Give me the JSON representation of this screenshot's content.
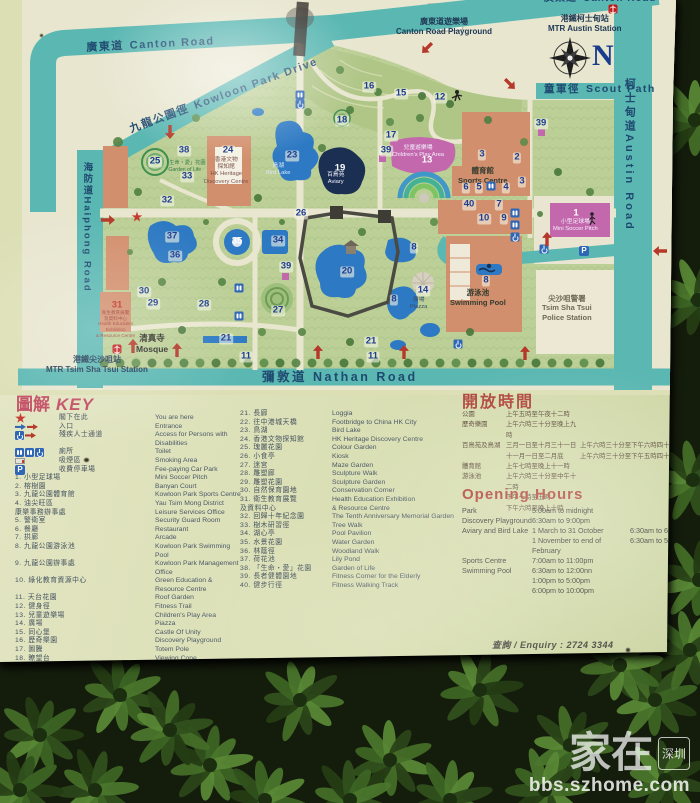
{
  "glyphs": {
    "parking": "P"
  },
  "colors": {
    "accent_red": "#b0443c",
    "road_teal": "#5ab7b2",
    "water_blue": "#2d79c3",
    "building_salmon": "#d28f6d",
    "magenta": "#c468ae",
    "marker_navy": "#1d3c8f"
  },
  "map": {
    "labels": [
      {
        "cls": "road",
        "x": 86,
        "y": 42,
        "rot": -3,
        "zh": "廣東道",
        "en": "Canton Road"
      },
      {
        "cls": "road cut",
        "x": 544,
        "y": -7,
        "rot": 0,
        "zh": "廣東道",
        "en": "Canton Road"
      },
      {
        "cls": "road",
        "x": 128,
        "y": 124,
        "rot": -20,
        "zh": "九龍公園徑",
        "en": "Kowloon Park Drive"
      },
      {
        "cls": "station",
        "x": 548,
        "y": 14,
        "rot": 0,
        "zh": "港鐵柯士甸站",
        "en": "MTR Austin Station"
      },
      {
        "cls": "road scout",
        "x": 544,
        "y": 83,
        "rot": 0,
        "zh": "童軍徑",
        "en": "Scout Path"
      },
      {
        "cls": "roadv",
        "x": 622,
        "y": 78,
        "rot": 0,
        "zh": "柯士甸道",
        "en": "Austin Road"
      },
      {
        "cls": "roadv small",
        "x": 81,
        "y": 162,
        "rot": 0,
        "zh": "海防道",
        "en": "Haiphong Road"
      },
      {
        "cls": "road nathan",
        "x": 262,
        "y": 370,
        "rot": 0,
        "zh": "彌敦道",
        "en": "Nathan Road"
      },
      {
        "cls": "station",
        "x": 396,
        "y": 17,
        "rot": 0,
        "zh": "廣東道遊樂場",
        "en": "Canton Road Playground"
      },
      {
        "cls": "place",
        "x": 136,
        "y": 333,
        "rot": 0,
        "zh": "清真寺",
        "en": "Mosque"
      },
      {
        "cls": "station",
        "x": 46,
        "y": 355,
        "rot": 0,
        "zh": "港鐵尖沙咀站",
        "en": "MTR Tsim Sha Tsui Station"
      },
      {
        "cls": "place small",
        "x": 542,
        "y": 294,
        "rot": 0,
        "zh": "尖沙咀警署",
        "en": "Tsim Sha Tsui\nPolice Station"
      },
      {
        "cls": "bldg",
        "x": 458,
        "y": 166,
        "rot": 0,
        "zh": "體育館",
        "en": "Sports Centre"
      },
      {
        "cls": "bldg",
        "x": 450,
        "y": 288,
        "rot": 0,
        "zh": "游泳池",
        "en": "Swimming Pool"
      },
      {
        "cls": "tiny b",
        "x": 266,
        "y": 163,
        "rot": 0,
        "zh": "鳥湖",
        "en": "Bird Lake"
      },
      {
        "cls": "tiny w",
        "x": 327,
        "y": 172,
        "rot": 0,
        "zh": "百鳥苑",
        "en": "Aviary"
      },
      {
        "cls": "tiny w",
        "x": 392,
        "y": 145,
        "rot": 0,
        "zh": "兒童遊樂場",
        "en": "Children's Play Area"
      },
      {
        "cls": "tiny w",
        "x": 553,
        "y": 219,
        "rot": 0,
        "zh": "小型足球場",
        "en": "Mini Soccer Pitch"
      },
      {
        "cls": "tiny heri",
        "x": 204,
        "y": 157,
        "rot": 0,
        "zh": "香港文物\n探知館",
        "en": "HK Heritage\nDiscovery Centre"
      },
      {
        "cls": "tiny gl",
        "x": 164,
        "y": 160,
        "rot": 0,
        "zh": "「生命・愛」花園",
        "en": "Garden of Life"
      },
      {
        "cls": "tiny r2",
        "x": 96,
        "y": 310,
        "rot": 0,
        "zh": "衛生教育展覽\n及資料中心",
        "en": "Health Education\nExhibition\n& Resource Centre"
      },
      {
        "cls": "tiny",
        "x": 410,
        "y": 297,
        "rot": 0,
        "zh": "廣場",
        "en": "Piazza"
      },
      {
        "cls": "bigN",
        "x": 592,
        "y": 38,
        "rot": 0,
        "zh": "",
        "en": "N"
      }
    ],
    "markers": [
      [
        "16",
        369,
        87,
        ""
      ],
      [
        "15",
        401,
        94,
        ""
      ],
      [
        "12",
        440,
        98,
        ""
      ],
      [
        "18",
        342,
        121,
        ""
      ],
      [
        "17",
        391,
        136,
        ""
      ],
      [
        "39",
        386,
        151,
        ""
      ],
      [
        "13",
        427,
        161,
        "w"
      ],
      [
        "3",
        482,
        155,
        ""
      ],
      [
        "2",
        517,
        158,
        ""
      ],
      [
        "3",
        522,
        182,
        ""
      ],
      [
        "6",
        466,
        188,
        ""
      ],
      [
        "5",
        479,
        188,
        ""
      ],
      [
        "4",
        506,
        188,
        ""
      ],
      [
        "40",
        469,
        205,
        ""
      ],
      [
        "7",
        499,
        205,
        ""
      ],
      [
        "10",
        484,
        219,
        ""
      ],
      [
        "9",
        504,
        219,
        ""
      ],
      [
        "1",
        576,
        214,
        "w"
      ],
      [
        "39",
        541,
        124,
        ""
      ],
      [
        "25",
        155,
        162,
        ""
      ],
      [
        "38",
        184,
        151,
        ""
      ],
      [
        "33",
        187,
        177,
        ""
      ],
      [
        "24",
        228,
        151,
        ""
      ],
      [
        "23",
        292,
        156,
        ""
      ],
      [
        "19",
        340,
        169,
        "w"
      ],
      [
        "32",
        167,
        201,
        ""
      ],
      [
        "37",
        172,
        237,
        ""
      ],
      [
        "35",
        237,
        242,
        "w"
      ],
      [
        "34",
        278,
        241,
        ""
      ],
      [
        "36",
        175,
        256,
        ""
      ],
      [
        "26",
        301,
        214,
        ""
      ],
      [
        "20",
        347,
        272,
        ""
      ],
      [
        "30",
        144,
        292,
        ""
      ],
      [
        "29",
        153,
        304,
        ""
      ],
      [
        "28",
        204,
        305,
        ""
      ],
      [
        "31",
        117,
        306,
        "r"
      ],
      [
        "27",
        278,
        311,
        ""
      ],
      [
        "39",
        286,
        267,
        ""
      ],
      [
        "21",
        226,
        339,
        ""
      ],
      [
        "11",
        246,
        357,
        ""
      ],
      [
        "21",
        371,
        342,
        ""
      ],
      [
        "11",
        373,
        357,
        ""
      ],
      [
        "14",
        423,
        291,
        ""
      ],
      [
        "8",
        414,
        248,
        ""
      ],
      [
        "8",
        486,
        281,
        ""
      ],
      [
        "8",
        394,
        300,
        ""
      ]
    ],
    "icons": [
      [
        "mtr",
        613,
        9,
        0
      ],
      [
        "mtr",
        117,
        349,
        0
      ],
      [
        "compassdot",
        570,
        58,
        0
      ],
      [
        "toilet",
        300,
        95,
        0
      ],
      [
        "toilet",
        491,
        186,
        0
      ],
      [
        "toilet",
        515,
        213,
        0
      ],
      [
        "toilet",
        515,
        225,
        0
      ],
      [
        "toilet",
        239,
        288,
        0
      ],
      [
        "toilet",
        239,
        316,
        0
      ],
      [
        "wc",
        300,
        104,
        0
      ],
      [
        "wc",
        515,
        237,
        0
      ],
      [
        "wc",
        544,
        249,
        0
      ],
      [
        "wc",
        458,
        344,
        0
      ],
      [
        "p",
        584,
        251,
        0
      ],
      [
        "star",
        137,
        217,
        0
      ],
      [
        "arr",
        427,
        48,
        225
      ],
      [
        "arr",
        510,
        84,
        135
      ],
      [
        "arr",
        170,
        132,
        180
      ],
      [
        "arr",
        108,
        220,
        90
      ],
      [
        "arr",
        133,
        346,
        0
      ],
      [
        "arr",
        177,
        350,
        0
      ],
      [
        "arr",
        318,
        352,
        0
      ],
      [
        "arr",
        547,
        239,
        0
      ],
      [
        "arr",
        404,
        352,
        0
      ],
      [
        "arr",
        525,
        353,
        0
      ],
      [
        "arr",
        660,
        251,
        270
      ]
    ]
  },
  "key": {
    "title_zh": "圖解",
    "title_en": "KEY",
    "symbols": [
      {
        "icons": [
          "star"
        ],
        "zh": "閣下在此",
        "en": "You are here"
      },
      {
        "icons": [
          "arr-blue",
          "arr-red"
        ],
        "zh": "入口",
        "en": "Entrance"
      },
      {
        "icons": [
          "wc",
          "arr-red"
        ],
        "zh": "殘疾人士通道",
        "en": "Access for Persons with Disabilities"
      },
      {
        "icons": [
          "toilet",
          "toilet",
          "wc"
        ],
        "zh": "廁所",
        "en": "Toilet"
      },
      {
        "icons": [
          "smoke"
        ],
        "zh": "吸煙區",
        "en": "Smoking Area"
      },
      {
        "icons": [
          "p"
        ],
        "zh": "收費停車場",
        "en": "Fee-paying Car Park"
      }
    ],
    "items": [
      {
        "n": 1,
        "zh": "小型足球場",
        "en": "Mini Soccer Pitch"
      },
      {
        "n": 2,
        "zh": "榕樹園",
        "en": "Banyan Court"
      },
      {
        "n": 3,
        "zh": "九龍公園體育館",
        "en": "Kowloon Park Sports Centre"
      },
      {
        "n": 4,
        "zh": "油尖旺區\n康樂事務辦事處",
        "en": "Yau Tsim Mong District\nLeisure Services Office"
      },
      {
        "n": 5,
        "zh": "警衛室",
        "en": "Security Guard Room"
      },
      {
        "n": 6,
        "zh": "餐廳",
        "en": "Restaurant"
      },
      {
        "n": 7,
        "zh": "拱廊",
        "en": "Arcade"
      },
      {
        "n": 8,
        "zh": "九龍公園游泳池",
        "en": "Kowloon Park Swimming Pool"
      },
      {
        "n": 9,
        "zh": "九龍公園辦事處",
        "en": "Kowloon Park Management Office"
      },
      {
        "n": 10,
        "zh": "綠化教育資源中心",
        "en": "Green Education & Resource Centre"
      },
      {
        "n": 11,
        "zh": "天台花園",
        "en": "Roof Garden"
      },
      {
        "n": 12,
        "zh": "健身徑",
        "en": "Fitness Trail"
      },
      {
        "n": 13,
        "zh": "兒童遊樂場",
        "en": "Children's Play Area"
      },
      {
        "n": 14,
        "zh": "廣場",
        "en": "Piazza"
      },
      {
        "n": 15,
        "zh": "同心堡",
        "en": "Castle Of Unity"
      },
      {
        "n": 16,
        "zh": "歷奇樂園",
        "en": "Discovery Playground"
      },
      {
        "n": 17,
        "zh": "圖騰",
        "en": "Totem Pole"
      },
      {
        "n": 18,
        "zh": "瞭望台",
        "en": "Viewing Cone"
      },
      {
        "n": 19,
        "zh": "百鳥苑",
        "en": "Aviary"
      },
      {
        "n": 20,
        "zh": "中國花園",
        "en": "Chinese Garden"
      },
      {
        "n": 21,
        "zh": "長廊",
        "en": "Loggia"
      },
      {
        "n": 22,
        "zh": "往中港城天橋",
        "en": "Footbridge to China HK City"
      },
      {
        "n": 23,
        "zh": "鳥湖",
        "en": "Bird Lake"
      },
      {
        "n": 24,
        "zh": "香港文物探知館",
        "en": "HK Heritage Discovery Centre"
      },
      {
        "n": 25,
        "zh": "瑰麗花園",
        "en": "Colour Garden"
      },
      {
        "n": 26,
        "zh": "小食亭",
        "en": "Kiosk"
      },
      {
        "n": 27,
        "zh": "迷宮",
        "en": "Maze Garden"
      },
      {
        "n": 28,
        "zh": "雕塑廊",
        "en": "Sculpture Walk"
      },
      {
        "n": 29,
        "zh": "雕塑花園",
        "en": "Sculpture Garden"
      },
      {
        "n": 30,
        "zh": "自然保育園地",
        "en": "Conservation Corner"
      },
      {
        "n": 31,
        "zh": "衛生教育展覽\n及資料中心",
        "en": "Health Education Exhibition\n& Resource Centre"
      },
      {
        "n": 32,
        "zh": "回歸十年紀念園",
        "en": "The Tenth Anniversary Memorial Garden"
      },
      {
        "n": 33,
        "zh": "樹木研習徑",
        "en": "Tree Walk"
      },
      {
        "n": 34,
        "zh": "湖心亭",
        "en": "Pool Pavilion"
      },
      {
        "n": 35,
        "zh": "水景花園",
        "en": "Water Garden"
      },
      {
        "n": 36,
        "zh": "林蔭徑",
        "en": "Woodland Walk"
      },
      {
        "n": 37,
        "zh": "荷花池",
        "en": "Lily Pond"
      },
      {
        "n": 38,
        "zh": "「生命・愛」花園",
        "en": "Garden of Life"
      },
      {
        "n": 39,
        "zh": "長者健體園地",
        "en": "Fitness Corner for the Elderly"
      },
      {
        "n": 40,
        "zh": "健步行徑",
        "en": "Fitness Walking Track"
      }
    ]
  },
  "hours_zh": {
    "title": "開放時間",
    "rows": [
      {
        "name": "公園",
        "lines": [
          {
            "c1": "上午五時至午夜十二時",
            "c2": ""
          }
        ]
      },
      {
        "name": "歷奇樂園",
        "lines": [
          {
            "c1": "上午六時三十分至晚上九時",
            "c2": ""
          }
        ]
      },
      {
        "name": "百鳥苑及鳥湖",
        "lines": [
          {
            "c1": "三月一日至十月三十一日",
            "c2": "上午六時三十分至下午六時四十五分"
          },
          {
            "c1": "十一月一日至二月底",
            "c2": "上午六時三十分至下午五時四十五分"
          }
        ]
      },
      {
        "name": "體育館",
        "lines": [
          {
            "c1": "上午七時至晚上十一時",
            "c2": ""
          }
        ]
      },
      {
        "name": "游泳池",
        "lines": [
          {
            "c1": "上午六時三十分至中午十二時",
            "c2": ""
          },
          {
            "c1": "下午一時至五時",
            "c2": ""
          },
          {
            "c1": "下午六時至晚上十時",
            "c2": ""
          }
        ]
      }
    ]
  },
  "hours_en": {
    "title": "Opening Hours",
    "rows": [
      {
        "name": "Park",
        "lines": [
          {
            "c1": "5:00am to midnight",
            "c2": ""
          }
        ]
      },
      {
        "name": "Discovery Playground",
        "lines": [
          {
            "c1": "6:30am to 9:00pm",
            "c2": ""
          }
        ]
      },
      {
        "name": "Aviary and Bird Lake",
        "lines": [
          {
            "c1": "1 March to 31 October",
            "c2": "6:30am to 6:45pm"
          },
          {
            "c1": "1 November to end of February",
            "c2": "6:30am to 5:45pm"
          }
        ]
      },
      {
        "name": "Sports Centre",
        "lines": [
          {
            "c1": "7:00am to 11:00pm",
            "c2": ""
          }
        ]
      },
      {
        "name": "Swimming Pool",
        "lines": [
          {
            "c1": "6:30am to 12:00nn",
            "c2": ""
          },
          {
            "c1": "1:00pm to 5:00pm",
            "c2": ""
          },
          {
            "c1": "6:00pm to 10:00pm",
            "c2": ""
          }
        ]
      }
    ]
  },
  "enquiry": "查詢 / Enquiry : 2724 3344",
  "watermark": {
    "brand": "家在",
    "badge": "深圳",
    "site": "bbs.szhome.com"
  }
}
